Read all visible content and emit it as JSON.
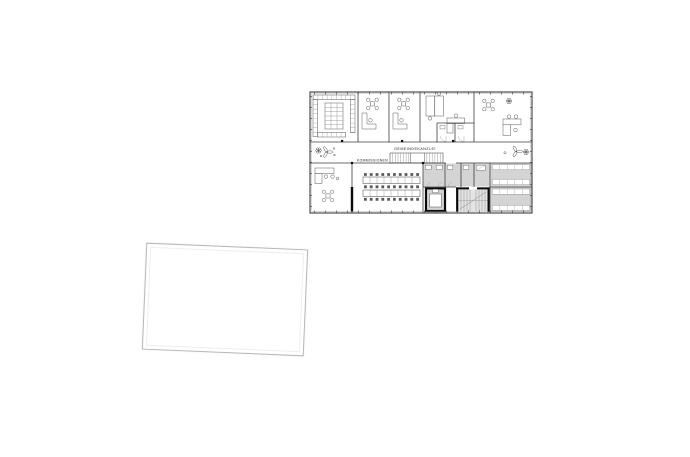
{
  "page": {
    "background_color": "#ffffff"
  },
  "floor_plan": {
    "labels": {
      "corridor_label": "GEMEINDEKANZLEI",
      "commissions_label": "KOMMISSIONEN"
    },
    "colors": {
      "line": "#3d3d3d",
      "dark_wall": "#0a0a0a",
      "room_fill": "#ffffff",
      "service_fill": "#d6d6d6",
      "stair_fill": "#e4e4e4",
      "hatch_line": "#c6c6c6",
      "tread_line": "#8d8d8d"
    }
  },
  "blank_sheet": {
    "fill": "#ffffff",
    "border_color": "#b7b7b7",
    "rotation_deg": 2.4
  }
}
